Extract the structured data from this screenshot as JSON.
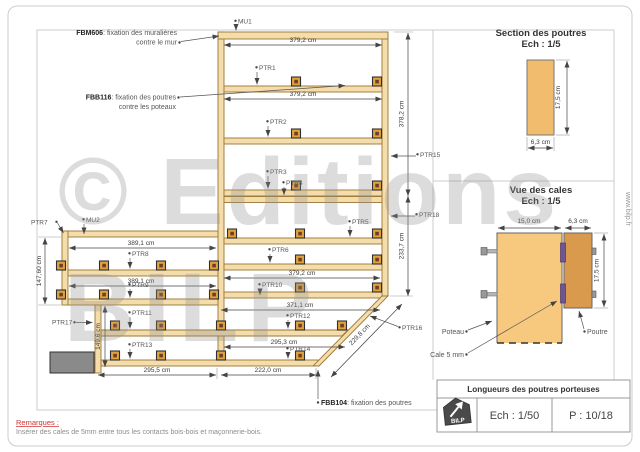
{
  "watermark": {
    "line1": "© Editions",
    "line2": "BILP"
  },
  "site_url": "www.bilp.fr",
  "notes": {
    "fbm606": {
      "code": "FBM606",
      "rest": ": fixation des  muralières",
      "line2": "contre le mur"
    },
    "fbb116": {
      "code": "FBB116",
      "rest": ": fixation des poutres",
      "line2": "contre les poteaux"
    },
    "fbb104": {
      "code": "FBB104",
      "rest": ": fixation des poutres"
    }
  },
  "labels": {
    "mu1": "MU1",
    "mu2": "MU2",
    "ptr1": "PTR1",
    "ptr2": "PTR2",
    "ptr3": "PTR3",
    "ptr4": "PTR4",
    "ptr5": "PTR5",
    "ptr6": "PTR6",
    "ptr7": "PTR7",
    "ptr8": "PTR8",
    "ptr9": "PTR9",
    "ptr10": "PTR10",
    "ptr11": "PTR11",
    "ptr12": "PTR12",
    "ptr13": "PTR13",
    "ptr14": "PTR14",
    "ptr15": "PTR15",
    "ptr16": "PTR16",
    "ptr17": "PTR17",
    "ptr18": "PTR18"
  },
  "dims": {
    "top_a": "379,2 cm",
    "top_b": "379,2 cm",
    "mid_right": "379,2 cm",
    "right_upper": "378,2 cm",
    "right_lower": "233,7 cm",
    "left_a": "389,1 cm",
    "left_b": "389,1 cm",
    "bottom_371": "371,1 cm",
    "bottom_295a": "295,3 cm",
    "bottom_222": "222,0 cm",
    "bottom_295b": "295,5 cm",
    "diag": "229,8 cm",
    "left_height": "147,60 cm",
    "inner_height": "149,6 cm"
  },
  "section_panel": {
    "title": "Section des poutres",
    "scale": "Ech : 1/5",
    "height": "17,5 cm",
    "width": "6,3 cm"
  },
  "cales_panel": {
    "title": "Vue des cales",
    "scale": "Ech : 1/5",
    "poteau_width": "15,0 cm",
    "poutre_width": "6,3 cm",
    "poutre_height": "17,5 cm",
    "poteau": "Poteau",
    "cale": "Cale 5 mm",
    "poutre": "Poutre"
  },
  "title_block": {
    "title": "Longueurs des poutres porteuses",
    "scale": "Ech : 1/50",
    "page": "P : 10/18",
    "logo": "BILP"
  },
  "remarks": {
    "heading": "Remarques :",
    "body": "Insérer des cales de 5mm entre tous les contacts bois-bois et maçonnerie-bois."
  }
}
